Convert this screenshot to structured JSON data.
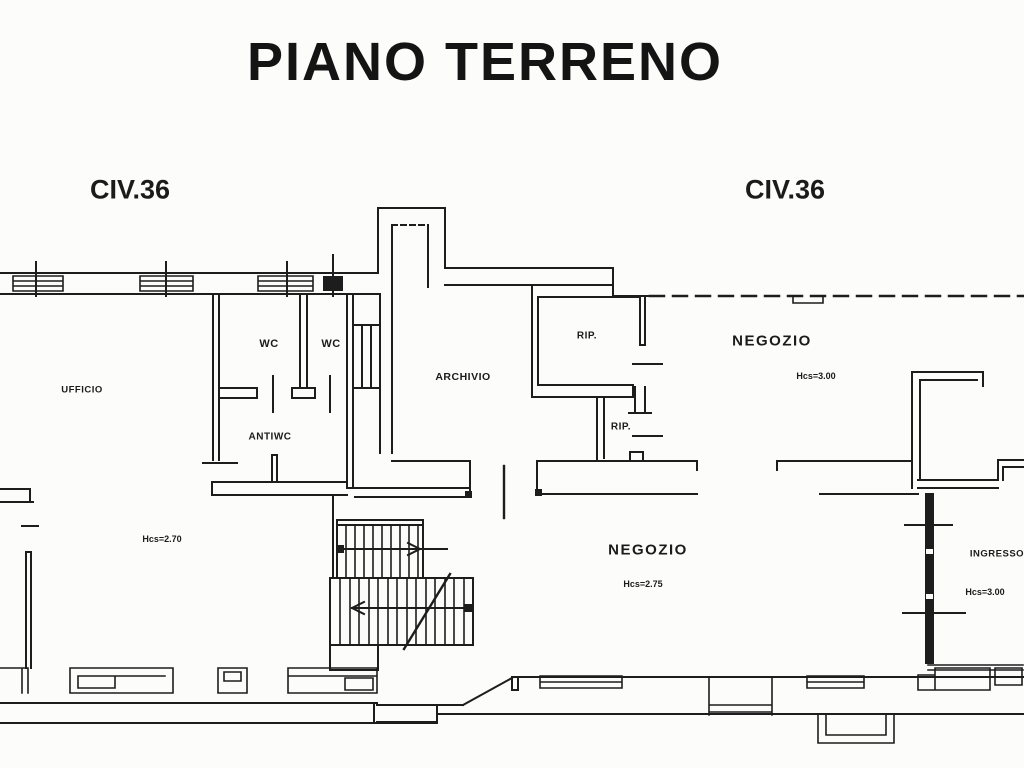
{
  "title": "PIANO TERRENO",
  "street_labels": {
    "left": "CIV.36",
    "right": "CIV.36"
  },
  "rooms": {
    "ufficio": {
      "label": "UFFICIO",
      "height_note": "Hcs=2.70"
    },
    "wc1": {
      "label": "WC"
    },
    "wc2": {
      "label": "WC"
    },
    "antiwc": {
      "label": "ANTIWC"
    },
    "archivio": {
      "label": "ARCHIVIO"
    },
    "rip1": {
      "label": "RIP."
    },
    "rip2": {
      "label": "RIP."
    },
    "negozio_top": {
      "label": "NEGOZIO",
      "height_note": "Hcs=3.00"
    },
    "negozio_bottom": {
      "label": "NEGOZIO",
      "height_note": "Hcs=2.75"
    },
    "ingresso": {
      "label": "INGRESSO",
      "height_note": "Hcs=3.00"
    }
  },
  "colors": {
    "ink": "#1d1d1d",
    "paper": "#fcfcfa"
  }
}
